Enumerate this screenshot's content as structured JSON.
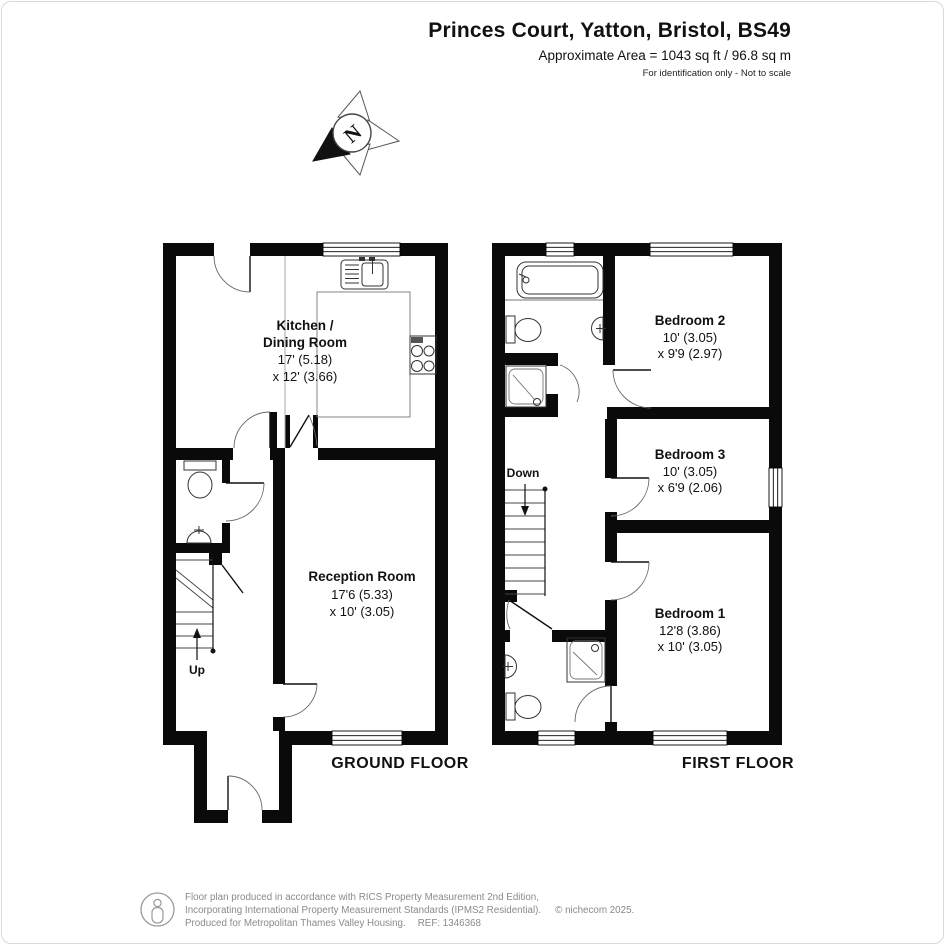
{
  "header": {
    "title": "Princes Court, Yatton, Bristol, BS49",
    "area": "Approximate Area = 1043 sq ft / 96.8 sq m",
    "note": "For identification only - Not to scale"
  },
  "compass": {
    "north": "N"
  },
  "ground_floor": {
    "label": "GROUND FLOOR",
    "kitchen": {
      "name_line1": "Kitchen /",
      "name_line2": "Dining Room",
      "dim_line1": "17' (5.18)",
      "dim_line2": "x 12' (3.66)"
    },
    "reception": {
      "name": "Reception Room",
      "dim_line1": "17'6 (5.33)",
      "dim_line2": "x 10' (3.05)"
    },
    "stairs_label": "Up"
  },
  "first_floor": {
    "label": "FIRST FLOOR",
    "bedroom2": {
      "name": "Bedroom 2",
      "dim_line1": "10' (3.05)",
      "dim_line2": "x 9'9 (2.97)"
    },
    "bedroom3": {
      "name": "Bedroom 3",
      "dim_line1": "10' (3.05)",
      "dim_line2": "x 6'9 (2.06)"
    },
    "bedroom1": {
      "name": "Bedroom 1",
      "dim_line1": "12'8 (3.86)",
      "dim_line2": "x 10' (3.05)"
    },
    "stairs_label": "Down"
  },
  "footer": {
    "line1": "Floor plan produced in accordance with RICS Property Measurement 2nd Edition,",
    "line2": "Incorporating International Property Measurement Standards (IPMS2 Residential).",
    "copyright": "© nichecom 2025.",
    "line3": "Produced for Metropolitan Thames Valley Housing.",
    "ref": "REF: 1346368"
  },
  "colors": {
    "wall": "#0a0a0a",
    "muted": "#8a8a8a"
  }
}
